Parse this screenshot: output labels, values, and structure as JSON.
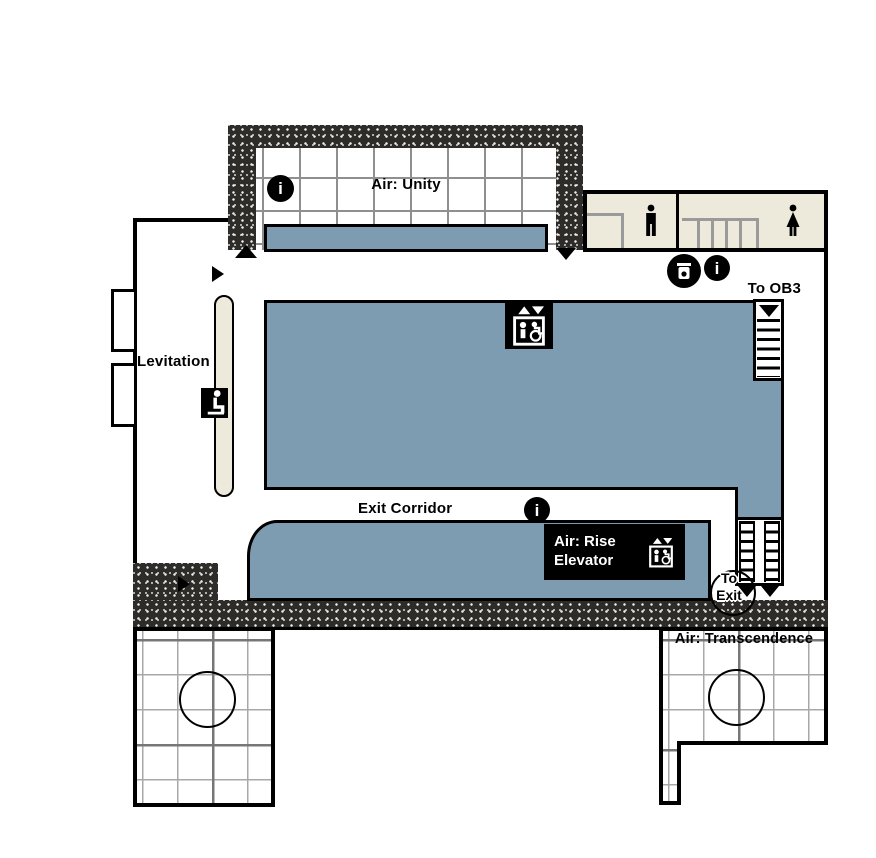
{
  "colors": {
    "wall_dark": "#2e2c29",
    "floor_blue": "#7e9cb1",
    "floor_beige": "#ede9db",
    "outline_black": "#000000",
    "grid_gray": "#8f8f8f"
  },
  "rooms": {
    "air_unity": {
      "label": "Air: Unity"
    },
    "levitation": {
      "label": "Levitation"
    },
    "exit_corridor": {
      "label": "Exit Corridor"
    },
    "air_rise": {
      "line1": "Air: Rise",
      "line2": "Elevator"
    },
    "air_transcendence": {
      "label": "Air: Transcendence"
    }
  },
  "signs": {
    "to_ob3": "To OB3",
    "to_exit_line1": "To",
    "to_exit_line2": "Exit"
  },
  "icons": {
    "info": "i"
  }
}
